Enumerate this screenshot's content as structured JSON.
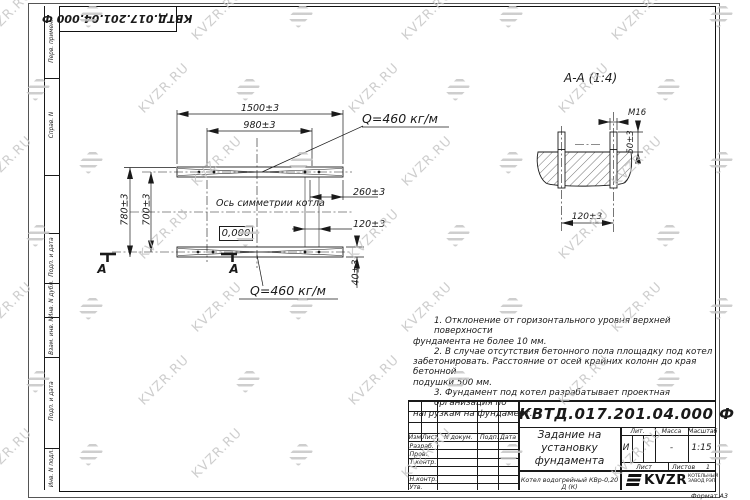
{
  "watermark": {
    "text": "KVZR.RU"
  },
  "stamp_top": {
    "doc_number": "КВТД.017.201.04.000 Ф"
  },
  "margin_labels": [
    "Перв. примен.",
    "Справ. N",
    "Подп. и дата",
    "Инв. N дубл.",
    "Взам. инв. N",
    "Подп. и дата",
    "Инв. N подл."
  ],
  "plan": {
    "dim_1500": "1500±3",
    "dim_980": "980±3",
    "dim_780": "780±3",
    "dim_700": "700±3",
    "dim_260": "260±3",
    "dim_120": "120±3",
    "dim_40": "40±3",
    "elevation": "0,000",
    "axis_label": "Ось симметрии котла",
    "load_label_top": "Q=460 кг/м",
    "load_label_bottom": "Q=460 кг/м",
    "section_letter": "А"
  },
  "section": {
    "title": "А-А (1:4)",
    "bolt_label": "М16",
    "dim_50": "50±3",
    "dim_120": "120±3"
  },
  "notes": {
    "lines": [
      "1. Отклонение от горизонтального уровня верхней поверхности",
      "фундамента не более 10 мм.",
      "2. В случае отсутствия бетонного пола площадку под котел",
      "забетонировать. Расстояние от осей крайних колонн до края бетонной",
      "подушки 500 мм.",
      "3. Фундамент под котел разрабатывает проектная организация по",
      "нагрузкам на фундамент."
    ]
  },
  "title_block": {
    "doc_number": "КВТД.017.201.04.000 Ф",
    "title_line1": "Задание на",
    "title_line2": "установку",
    "title_line3": "фундамента",
    "product": "Котел водогрейный КВр-0,20 Д (К)",
    "col_izm": "Изм",
    "col_list": "Лист",
    "col_ndoc": "N докум.",
    "col_podp": "Подп.",
    "col_data": "Дата",
    "rows": [
      "Разраб.",
      "Пров.",
      "Т.контр.",
      "",
      "Н.контр.",
      "Утв."
    ],
    "lit_label": "Лит.",
    "mass_label": "Масса",
    "scale_label": "Масштаб",
    "lit_value": "И",
    "mass_value": "-",
    "scale_value": "1:15",
    "sheet_label": "Лист",
    "sheets_label": "Листов",
    "sheets_value": "1",
    "logo_text": "KVZR",
    "logo_sub1": "КОТЕЛЬНЫЙ",
    "logo_sub2": "ЗАВОД РЭП",
    "format_label": "Формат А3"
  },
  "colors": {
    "line": "#1a1a1a",
    "watermark": "#c6c6c6"
  }
}
